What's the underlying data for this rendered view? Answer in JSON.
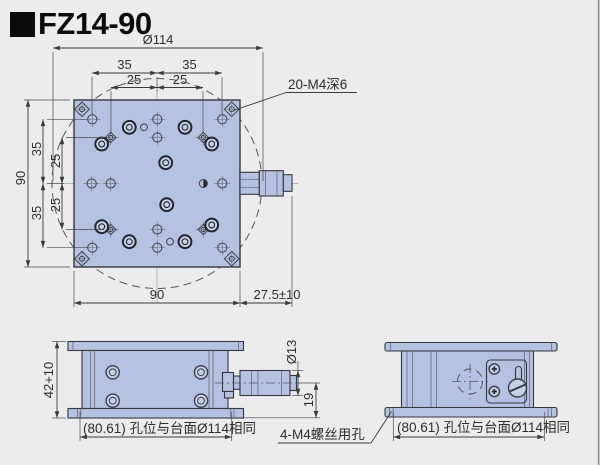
{
  "title": {
    "model": "FZ14-90"
  },
  "colors": {
    "background": "#ececec",
    "part_fill": "#b5c2e1",
    "part_fill_light": "#c7d1e9",
    "edge": "#36363e",
    "dimension": "#3a3a3a",
    "border_line": "#8f8f8f"
  },
  "top_view": {
    "dia_label": "Ø114",
    "top_35_left": "35",
    "top_35_right": "35",
    "top_25_left": "25",
    "top_25_right": "25",
    "left_90": "90",
    "left_35_top": "35",
    "left_25_top": "25",
    "left_25_bottom": "25",
    "left_35_bottom": "35",
    "bottom_90": "90",
    "micrometer_dim": "27.5±10",
    "thread_note": "20-M4深6"
  },
  "front_view": {
    "height_dim": "42+10",
    "knob_dia_dim": "Ø13",
    "axis_dim": "19",
    "base_note": "(80.61) 孔位与台面Ø114相同"
  },
  "side_view": {
    "base_note": "(80.61) 孔位与台面Ø114相同",
    "screw_note": "4-M4螺丝用孔"
  }
}
